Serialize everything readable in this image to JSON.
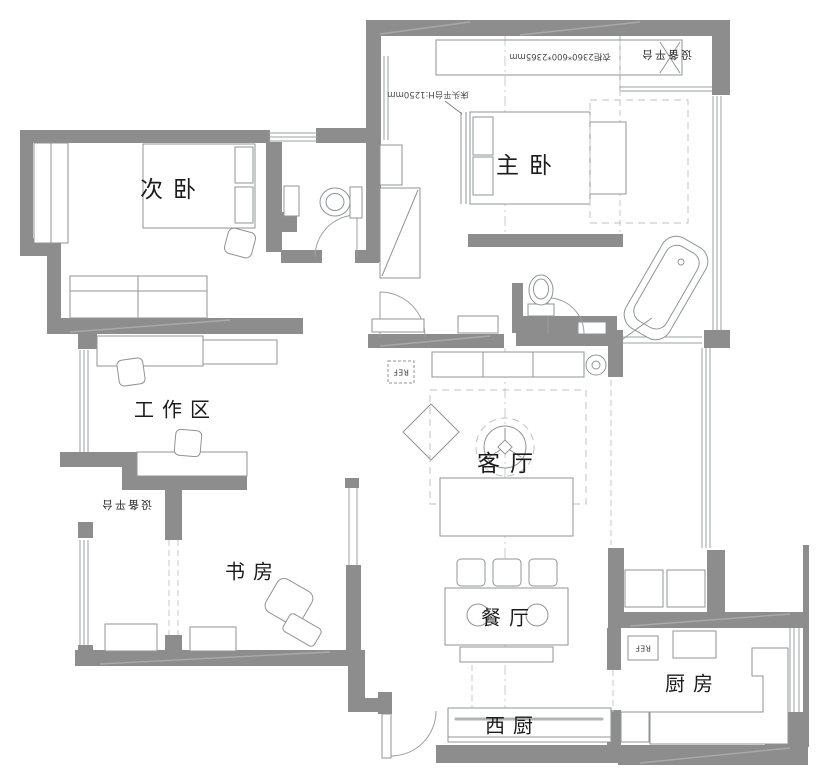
{
  "plan": {
    "rooms": {
      "secondary_bedroom": "次卧",
      "master_bedroom": "主卧",
      "work_area": "工作区",
      "living_room": "客厅",
      "study": "书房",
      "dining_room": "餐厅",
      "west_kitchen": "西厨",
      "kitchen": "厨房"
    },
    "balconies": {
      "north_platform": "设备平台",
      "west_platform": "设备平台"
    },
    "annotations": {
      "wardrobe_size": "衣柜2360*600*2365mm",
      "headboard_platform": "床头平台H:1250mm"
    },
    "appliances": {
      "refrigerator": "REF"
    },
    "colors": {
      "wall": "#8d8d8d",
      "furniture_line": "#8f9496",
      "dashed_line": "#c4c8c8",
      "text": "#1c1c1c",
      "background": "#ffffff"
    }
  }
}
